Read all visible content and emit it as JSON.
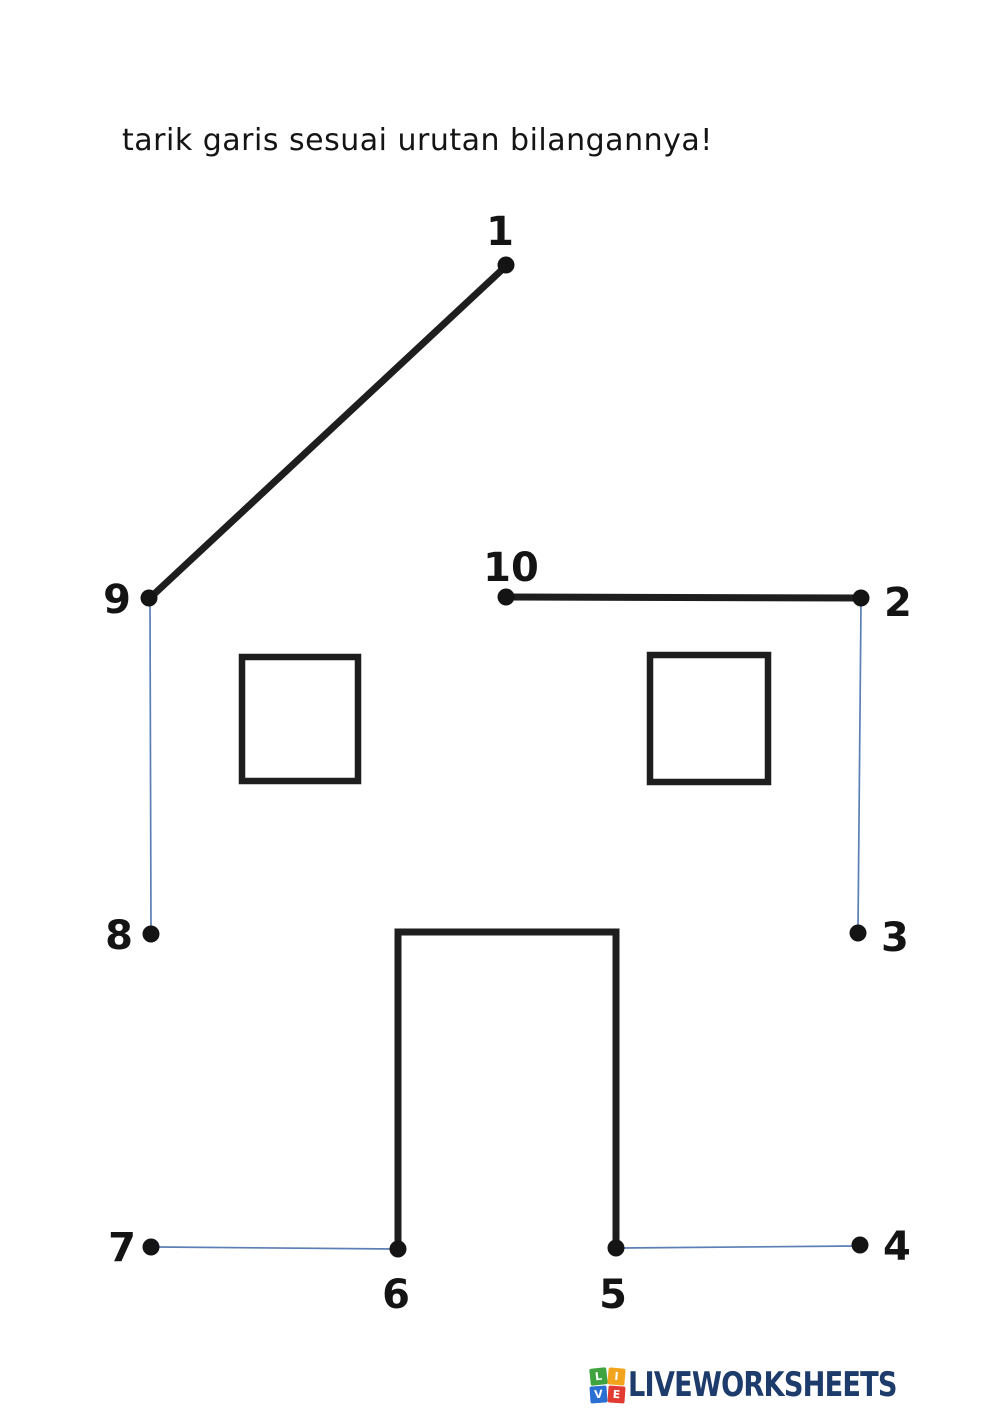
{
  "title": "tarik garis sesuai urutan bilangannya!",
  "colors": {
    "ink": "#1e1e1e",
    "dot": "#141414",
    "drawn_line": "#5b7fb5",
    "logo_text": "#1d3c6b"
  },
  "puzzle": {
    "printed_stroke_width": 7,
    "window_stroke_width": 6.5,
    "drawn_stroke_width": 1.7,
    "dot_radius": 8.5,
    "label_font_size": 40,
    "printed_segments": [
      {
        "name": "roof-left-line",
        "x1": 506,
        "y1": 266,
        "x2": 151,
        "y2": 597
      },
      {
        "name": "wall-top-line",
        "x1": 506,
        "y1": 597,
        "x2": 861,
        "y2": 598
      }
    ],
    "printed_polylines": [
      {
        "name": "door-outline",
        "points": "398,1248 398,932 616,932 616,1248"
      }
    ],
    "windows": [
      {
        "name": "window-left",
        "x": 242,
        "y": 657,
        "w": 116,
        "h": 124
      },
      {
        "name": "window-right",
        "x": 650,
        "y": 655,
        "w": 118,
        "h": 127
      }
    ],
    "drawn_segments": [
      {
        "name": "drawn-line-9-8",
        "x1": 150,
        "y1": 605,
        "x2": 151,
        "y2": 930
      },
      {
        "name": "drawn-line-2-3",
        "x1": 861,
        "y1": 605,
        "x2": 858,
        "y2": 929
      },
      {
        "name": "drawn-line-7-6",
        "x1": 157,
        "y1": 1247,
        "x2": 395,
        "y2": 1249
      },
      {
        "name": "drawn-line-5-4",
        "x1": 622,
        "y1": 1248,
        "x2": 855,
        "y2": 1246
      }
    ],
    "dots": [
      {
        "label": "1",
        "x": 506,
        "y": 265,
        "lx": 500,
        "ly": 245,
        "anchor": "middle"
      },
      {
        "label": "2",
        "x": 861,
        "y": 598,
        "lx": 884,
        "ly": 616,
        "anchor": "start"
      },
      {
        "label": "3",
        "x": 858,
        "y": 933,
        "lx": 881,
        "ly": 951,
        "anchor": "start"
      },
      {
        "label": "4",
        "x": 860,
        "y": 1245,
        "lx": 883,
        "ly": 1260,
        "anchor": "start"
      },
      {
        "label": "5",
        "x": 616,
        "y": 1248,
        "lx": 613,
        "ly": 1308,
        "anchor": "middle"
      },
      {
        "label": "6",
        "x": 398,
        "y": 1249,
        "lx": 396,
        "ly": 1308,
        "anchor": "middle"
      },
      {
        "label": "7",
        "x": 151,
        "y": 1247,
        "lx": 136,
        "ly": 1261,
        "anchor": "end"
      },
      {
        "label": "8",
        "x": 151,
        "y": 934,
        "lx": 133,
        "ly": 949,
        "anchor": "end"
      },
      {
        "label": "9",
        "x": 149,
        "y": 598,
        "lx": 131,
        "ly": 613,
        "anchor": "end"
      },
      {
        "label": "10",
        "x": 506,
        "y": 597,
        "lx": 511,
        "ly": 581,
        "anchor": "middle"
      }
    ]
  },
  "footer": {
    "brand": "LIVEWORKSHEETS",
    "icon_cells": [
      {
        "letter": "L",
        "color": "#3fa440"
      },
      {
        "letter": "I",
        "color": "#f2a51c"
      },
      {
        "letter": "V",
        "color": "#2a70d3"
      },
      {
        "letter": "E",
        "color": "#e23b31"
      }
    ]
  }
}
